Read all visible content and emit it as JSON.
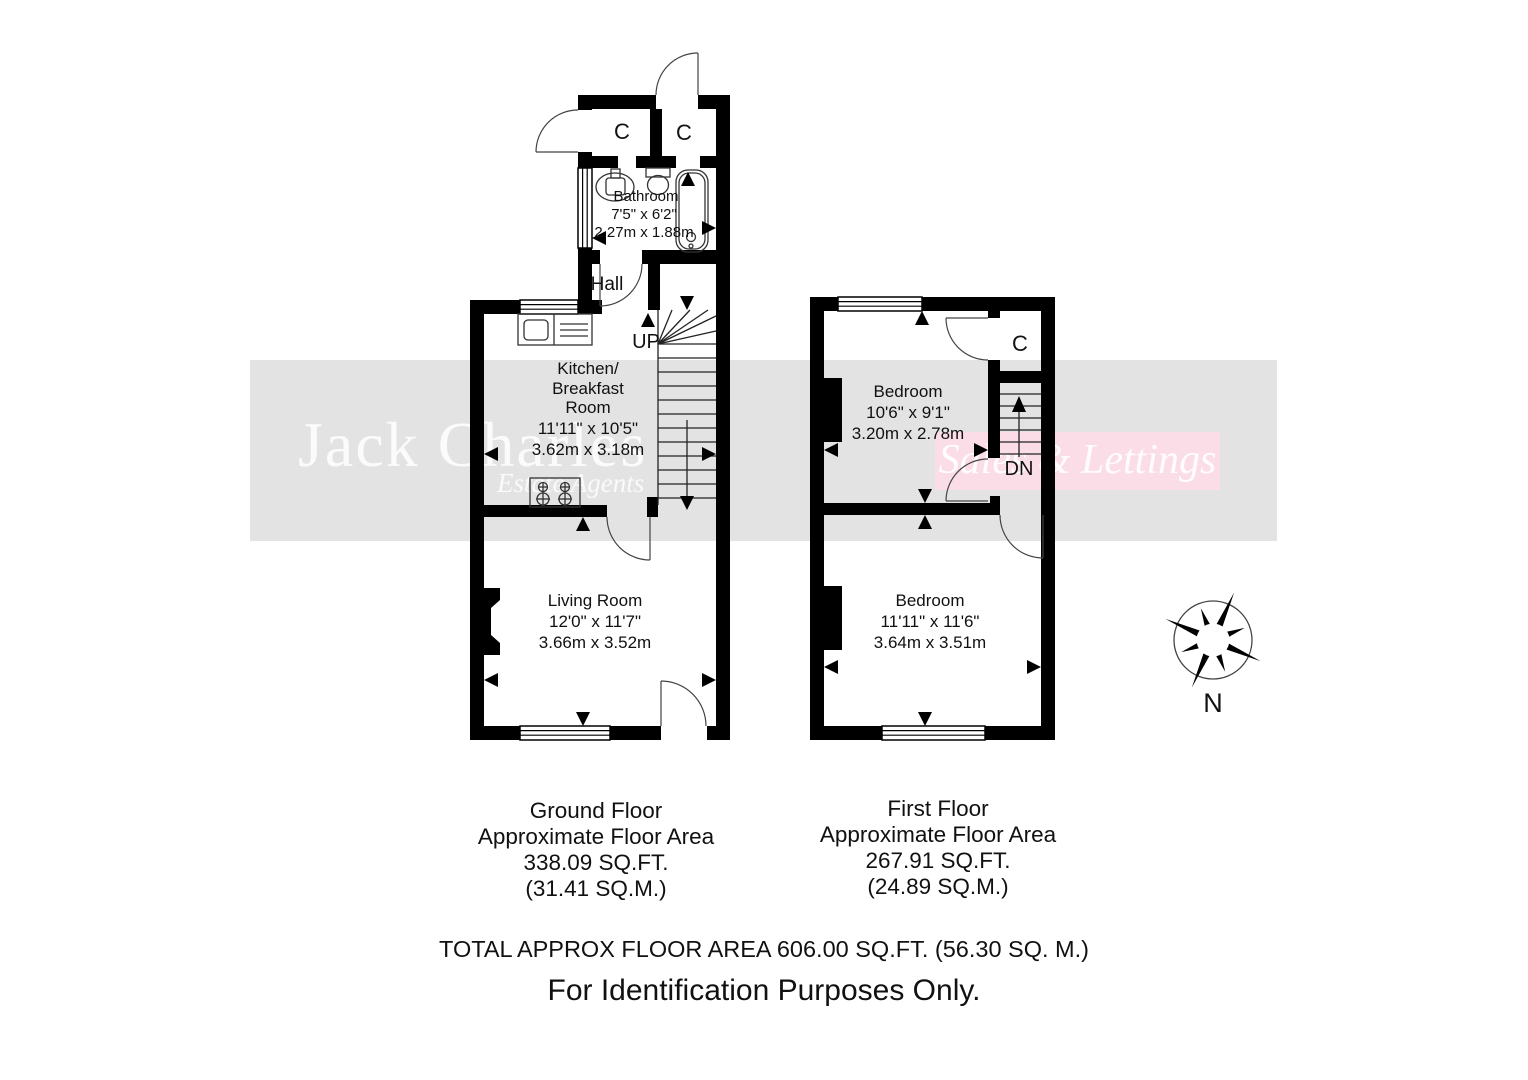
{
  "watermark": {
    "brand": "Jack Charles",
    "brand_sub": "Estate Agents",
    "tagline": "Sales & Lettings"
  },
  "compass": {
    "label": "N"
  },
  "ground_floor": {
    "closet1": "C",
    "closet2": "C",
    "bathroom": {
      "name": "Bathroom",
      "imperial": "7'5\" x 6'2\"",
      "metric": "2.27m x 1.88m"
    },
    "hall": "Hall",
    "stairs_label": "UP",
    "kitchen": {
      "line1": "Kitchen/",
      "line2": "Breakfast",
      "line3": "Room",
      "imperial": "11'11\" x 10'5\"",
      "metric": "3.62m x 3.18m"
    },
    "living": {
      "name": "Living Room",
      "imperial": "12'0\" x 11'7\"",
      "metric": "3.66m x 3.52m"
    },
    "caption": [
      "Ground Floor",
      "Approximate Floor Area",
      "338.09 SQ.FT.",
      "(31.41 SQ.M.)"
    ]
  },
  "first_floor": {
    "closet": "C",
    "stairs_label": "DN",
    "bedroom_rear": {
      "name": "Bedroom",
      "imperial": "10'6\" x 9'1\"",
      "metric": "3.20m x 2.78m"
    },
    "bedroom_front": {
      "name": "Bedroom",
      "imperial": "11'11\" x 11'6\"",
      "metric": "3.64m x 3.51m"
    },
    "caption": [
      "First Floor",
      "Approximate Floor Area",
      "267.91 SQ.FT.",
      "(24.89 SQ.M.)"
    ]
  },
  "footer": {
    "total": "TOTAL APPROX FLOOR AREA 606.00 SQ.FT. (56.30 SQ. M.)",
    "disclaimer": "For Identification Purposes Only."
  }
}
